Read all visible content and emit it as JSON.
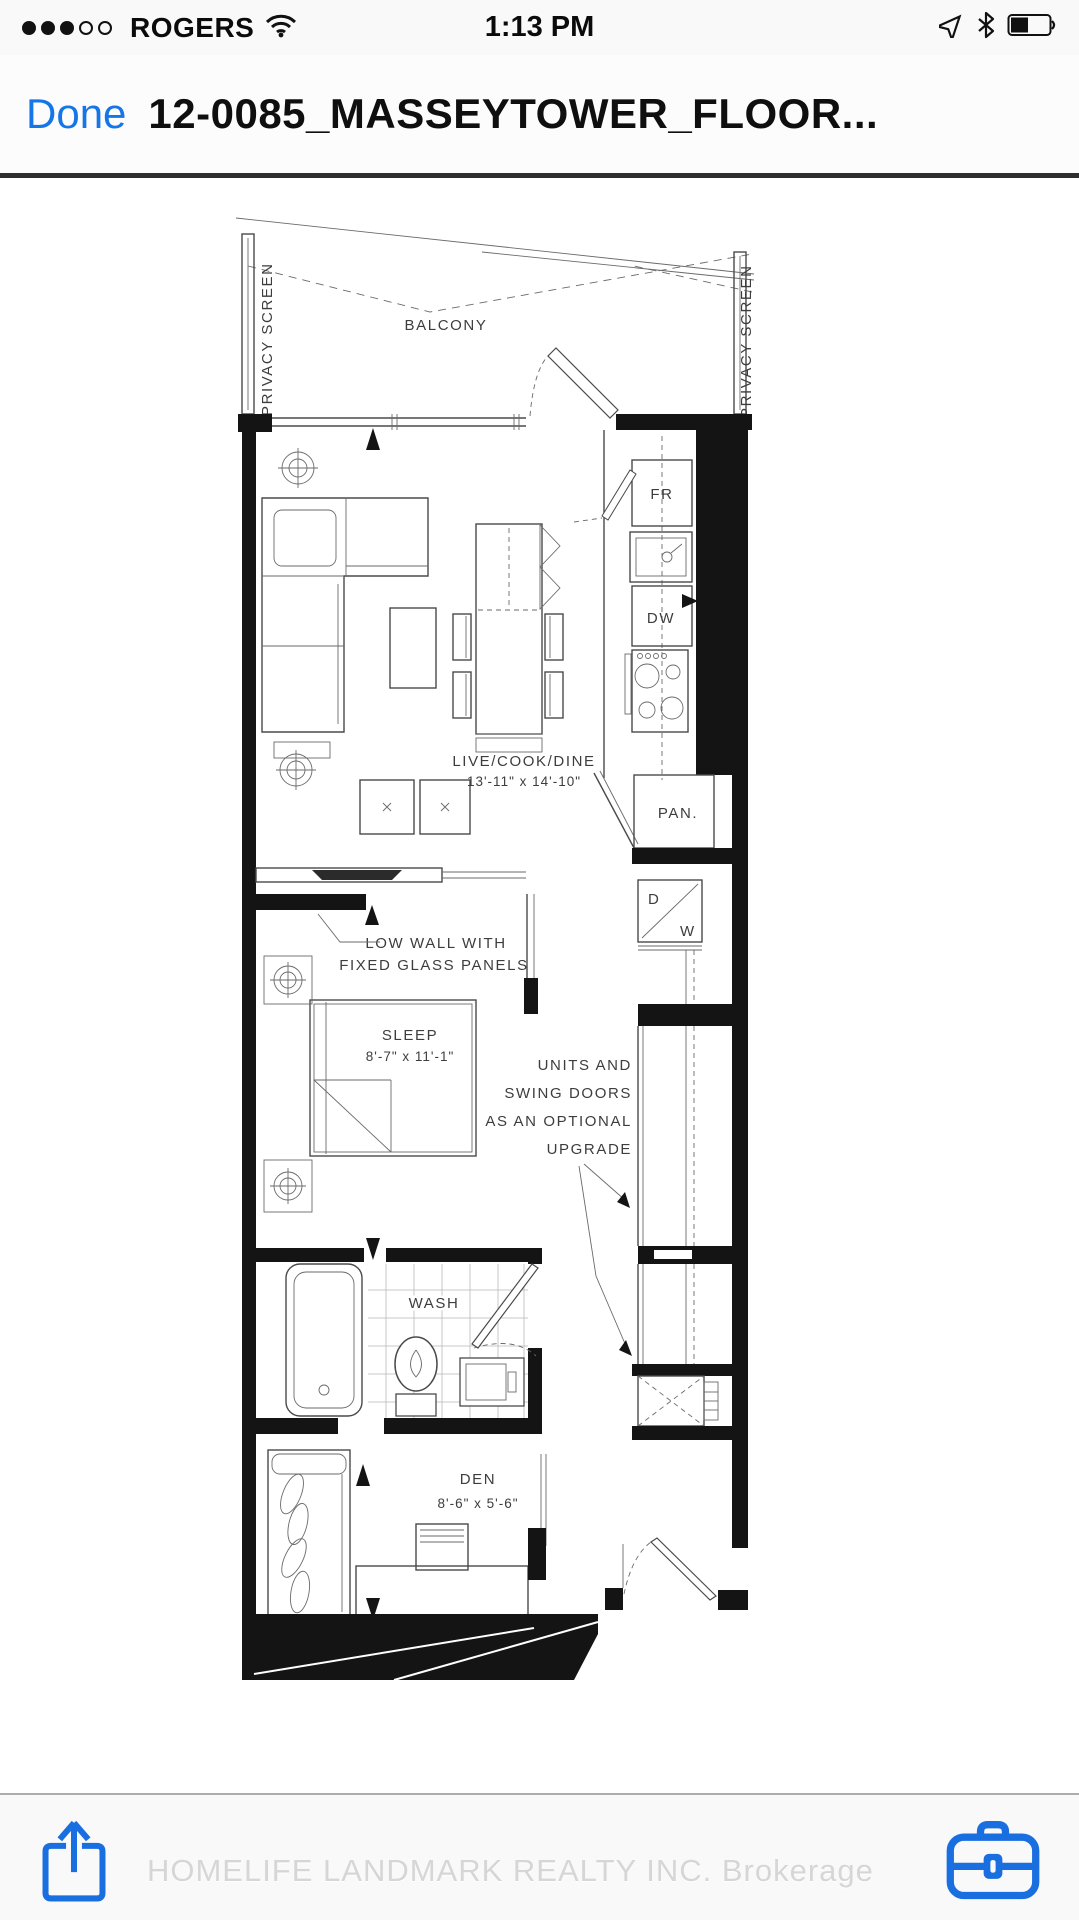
{
  "status_bar": {
    "carrier": "ROGERS",
    "time": "1:13 PM",
    "signal": {
      "filled": 3,
      "total": 5
    },
    "battery_fill_pct": 45
  },
  "nav_bar": {
    "done": "Done",
    "title": "12-0085_MASSEYTOWER_FLOOR...",
    "accent_color": "#1676e8"
  },
  "floor_plan": {
    "balcony": "BALCONY",
    "privacy_screen_left": "PRIVACY SCREEN",
    "privacy_screen_right": "PRIVACY SCREEN",
    "live_cook_dine": "LIVE/COOK/DINE",
    "live_cook_dine_dim": "13'-11\" x 14'-10\"",
    "pantry": "PAN.",
    "fridge": "FR",
    "dishwasher": "DW",
    "dryer": "D",
    "washer": "W",
    "low_wall_note": [
      "LOW WALL WITH",
      "FIXED GLASS PANELS"
    ],
    "sleep": "SLEEP",
    "sleep_dim": "8'-7\" x 11'-1\"",
    "units_note": [
      "UNITS AND",
      "SWING DOORS",
      "AS AN OPTIONAL",
      "UPGRADE"
    ],
    "wash": "WASH",
    "den": "DEN",
    "den_dim": "8'-6\" x 5'-6\""
  },
  "watermark": "HOMELIFE LANDMARK REALTY INC.  Brokerage"
}
